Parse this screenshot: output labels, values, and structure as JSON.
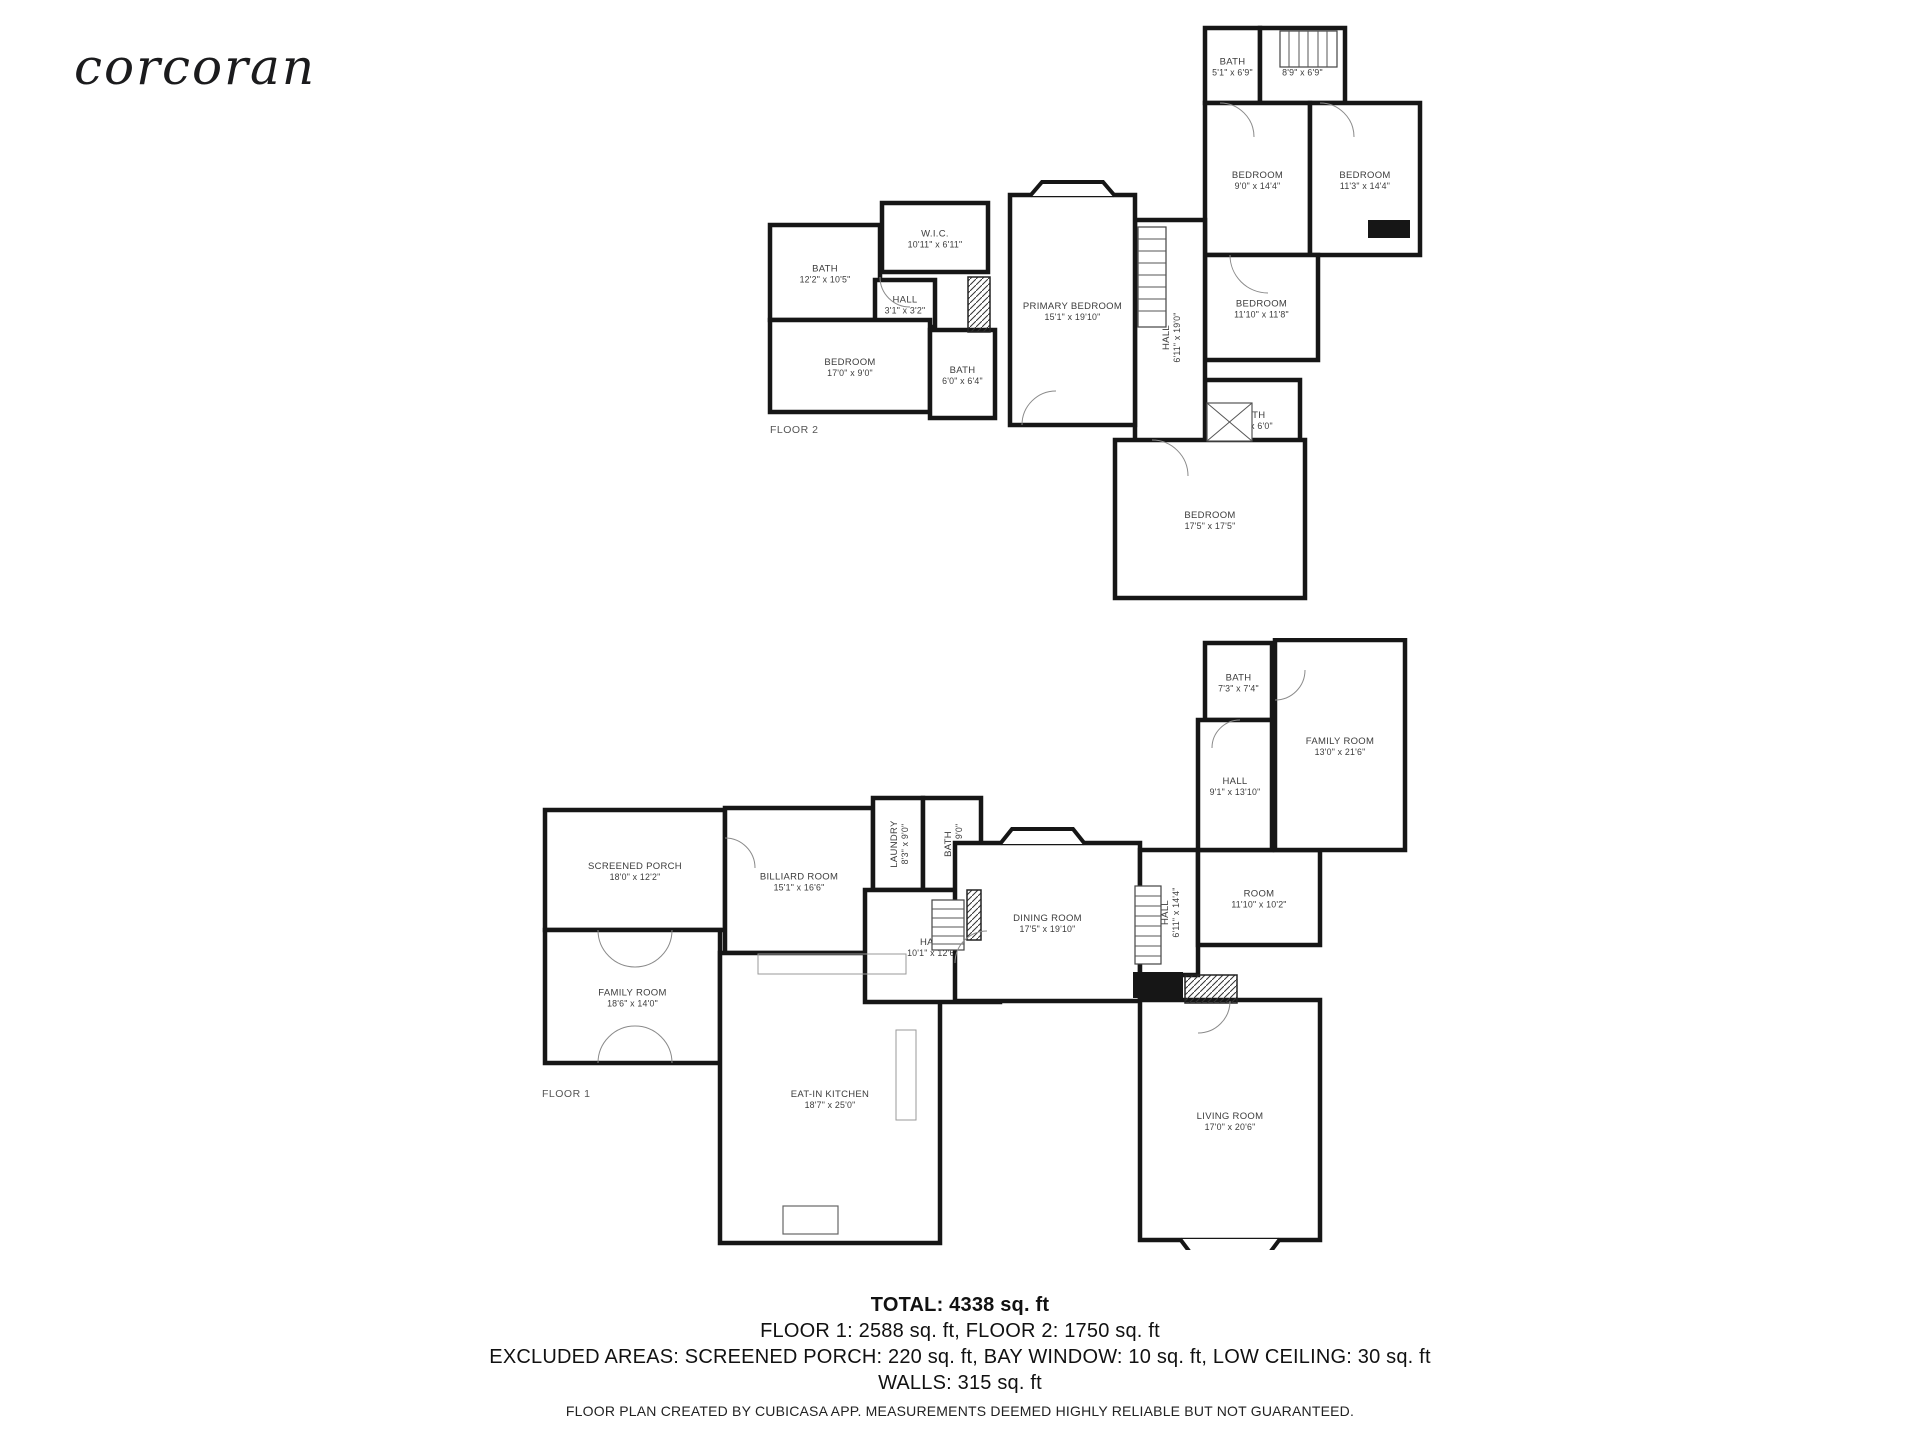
{
  "brand": {
    "logo": "corcoran"
  },
  "floor2": {
    "label": "FLOOR 2",
    "rooms": [
      {
        "name": "BATH",
        "dims": "5'1\" x 6'9\"",
        "x": 445,
        "y": 13,
        "w": 55,
        "h": 75
      },
      {
        "name": "HALL",
        "dims": "8'9\" x 6'9\"",
        "x": 500,
        "y": 13,
        "w": 85,
        "h": 75
      },
      {
        "name": "BEDROOM",
        "dims": "9'0\" x 14'4\"",
        "x": 445,
        "y": 88,
        "w": 105,
        "h": 152
      },
      {
        "name": "BEDROOM",
        "dims": "11'3\" x 14'4\"",
        "x": 550,
        "y": 88,
        "w": 110,
        "h": 152
      },
      {
        "name": "BEDROOM",
        "dims": "11'10\" x 11'8\"",
        "x": 445,
        "y": 240,
        "w": 113,
        "h": 105
      },
      {
        "name": "BATH",
        "dims": "4'0\" x 6'0\"",
        "x": 445,
        "y": 365,
        "w": 95,
        "h": 78
      },
      {
        "name": "HALL",
        "dims": "6'11\" x 19'0\"",
        "x": 375,
        "y": 205,
        "w": 70,
        "h": 235,
        "vertical": true
      },
      {
        "name": "BEDROOM",
        "dims": "17'5\" x 17'5\"",
        "x": 355,
        "y": 425,
        "w": 190,
        "h": 158
      },
      {
        "name": "PRIMARY BEDROOM",
        "dims": "15'1\" x 19'10\"",
        "x": 250,
        "y": 180,
        "w": 125,
        "h": 230
      },
      {
        "name": "W.I.C.",
        "dims": "10'11\" x 6'11\"",
        "x": 122,
        "y": 188,
        "w": 106,
        "h": 69
      },
      {
        "name": "BATH",
        "dims": "12'2\" x 10'5\"",
        "x": 10,
        "y": 210,
        "w": 110,
        "h": 95
      },
      {
        "name": "HALL",
        "dims": "3'1\" x 3'2\"",
        "x": 115,
        "y": 265,
        "w": 60,
        "h": 47
      },
      {
        "name": "BEDROOM",
        "dims": "17'0\" x 9'0\"",
        "x": 10,
        "y": 305,
        "w": 160,
        "h": 92
      },
      {
        "name": "BATH",
        "dims": "6'0\" x 6'4\"",
        "x": 170,
        "y": 315,
        "w": 65,
        "h": 88
      }
    ]
  },
  "floor1": {
    "label": "FLOOR 1",
    "rooms": [
      {
        "name": "SCREENED PORCH",
        "dims": "18'0\" x 12'2\"",
        "x": 5,
        "y": 172,
        "w": 180,
        "h": 120
      },
      {
        "name": "BILLIARD ROOM",
        "dims": "15'1\" x 16'6\"",
        "x": 185,
        "y": 170,
        "w": 148,
        "h": 145
      },
      {
        "name": "FAMILY ROOM",
        "dims": "18'6\" x 14'0\"",
        "x": 5,
        "y": 292,
        "w": 175,
        "h": 133
      },
      {
        "name": "EAT-IN KITCHEN",
        "dims": "18'7\" x 25'0\"",
        "x": 180,
        "y": 315,
        "w": 220,
        "h": 290
      },
      {
        "name": "LAUNDRY",
        "dims": "8'3\" x 9'0\"",
        "x": 333,
        "y": 160,
        "w": 50,
        "h": 92,
        "vertical": true
      },
      {
        "name": "BATH",
        "dims": "6'4\" x 9'0\"",
        "x": 383,
        "y": 160,
        "w": 58,
        "h": 92,
        "vertical": true
      },
      {
        "name": "HALL",
        "dims": "10'1\" x 12'6\"",
        "x": 325,
        "y": 252,
        "w": 135,
        "h": 112
      },
      {
        "name": "DINING ROOM",
        "dims": "17'5\" x 19'10\"",
        "x": 415,
        "y": 205,
        "w": 185,
        "h": 158
      },
      {
        "name": "HALL",
        "dims": "6'11\" x 14'4\"",
        "x": 600,
        "y": 212,
        "w": 58,
        "h": 125,
        "vertical": true
      },
      {
        "name": "ROOM",
        "dims": "11'10\" x 10'2\"",
        "x": 658,
        "y": 212,
        "w": 122,
        "h": 95
      },
      {
        "name": "LIVING ROOM",
        "dims": "17'0\" x 20'6\"",
        "x": 600,
        "y": 362,
        "w": 180,
        "h": 240
      },
      {
        "name": "BATH",
        "dims": "7'3\" x 7'4\"",
        "x": 665,
        "y": 5,
        "w": 67,
        "h": 77
      },
      {
        "name": "HALL",
        "dims": "9'1\" x 13'10\"",
        "x": 658,
        "y": 82,
        "w": 74,
        "h": 130
      },
      {
        "name": "FAMILY ROOM",
        "dims": "13'0\" x 21'6\"",
        "x": 735,
        "y": 2,
        "w": 130,
        "h": 210
      }
    ]
  },
  "summary": {
    "total": "TOTAL: 4338 sq. ft",
    "floors": "FLOOR 1: 2588 sq. ft, FLOOR 2: 1750 sq. ft",
    "excluded": "EXCLUDED AREAS: SCREENED PORCH: 220 sq. ft, BAY WINDOW: 10 sq. ft, LOW CEILING: 30 sq. ft",
    "walls": "WALLS: 315 sq. ft"
  },
  "disclaimer": "FLOOR PLAN CREATED BY CUBICASA APP. MEASUREMENTS DEEMED HIGHLY RELIABLE BUT NOT GUARANTEED."
}
